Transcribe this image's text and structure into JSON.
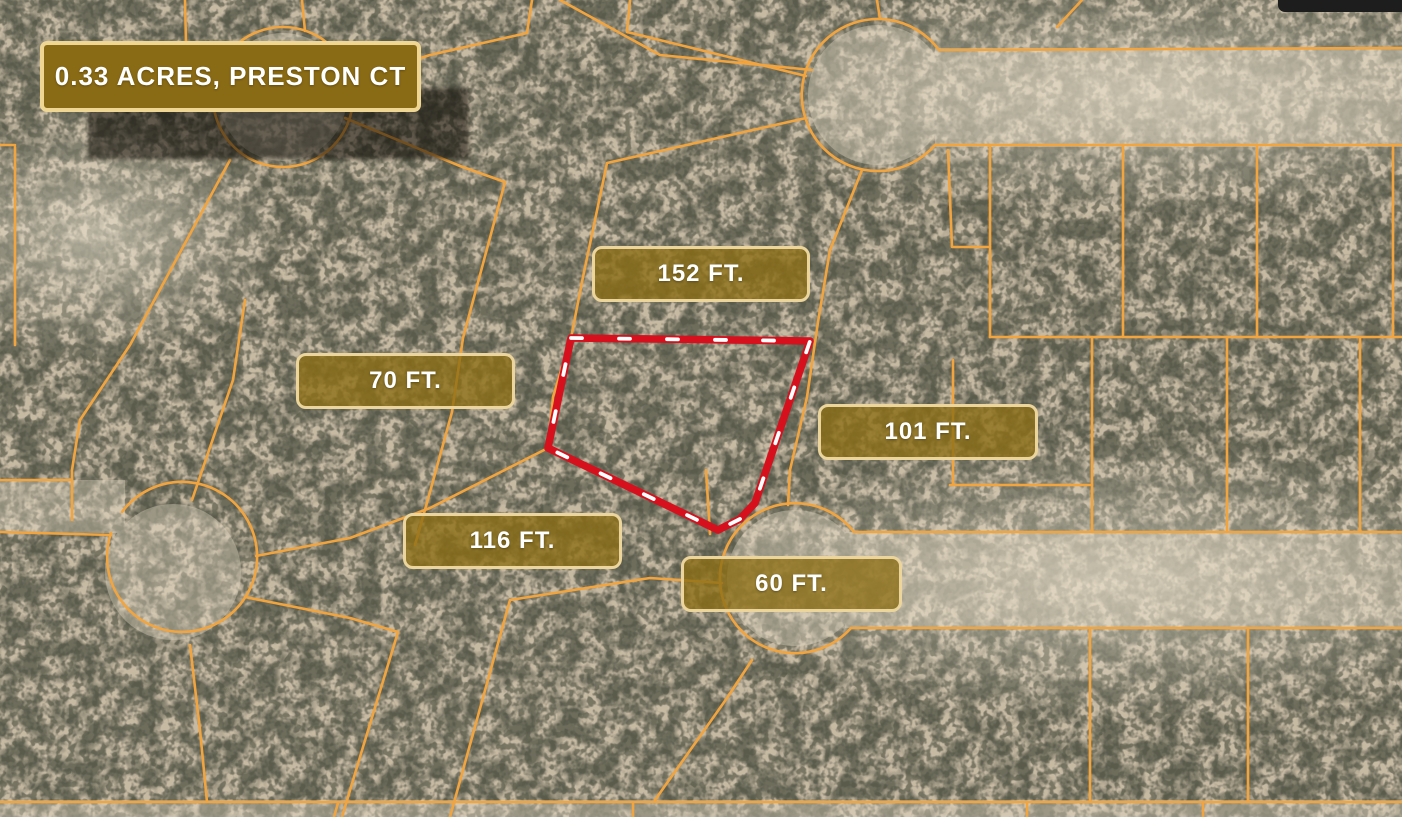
{
  "map": {
    "kind": "satellite-parcel-map",
    "title_badge": {
      "text": "0.33 ACRES, PRESTON CT"
    },
    "dimension_labels": [
      {
        "side": "north",
        "text": "152 FT."
      },
      {
        "side": "west",
        "text": "70 FT."
      },
      {
        "side": "east",
        "text": "101 FT."
      },
      {
        "side": "southwest",
        "text": "116 FT."
      },
      {
        "side": "south",
        "text": "60 FT."
      }
    ],
    "parcel": {
      "outline_points": "571,338 810,341 755,503 740,519 718,530 548,448",
      "outline_color": "#d6101d",
      "dash_color": "#ffffff"
    },
    "colors": {
      "boundary_lines": "#f2a43e",
      "title_badge_fill": "#8a6b15",
      "title_badge_border": "#f0d693",
      "dim_badge_fill": "rgba(140,110,20,0.78)",
      "dim_badge_border": "#ecd59c",
      "terrain_base": "#d7cbb6",
      "bush_dark": "#585a4b"
    }
  }
}
